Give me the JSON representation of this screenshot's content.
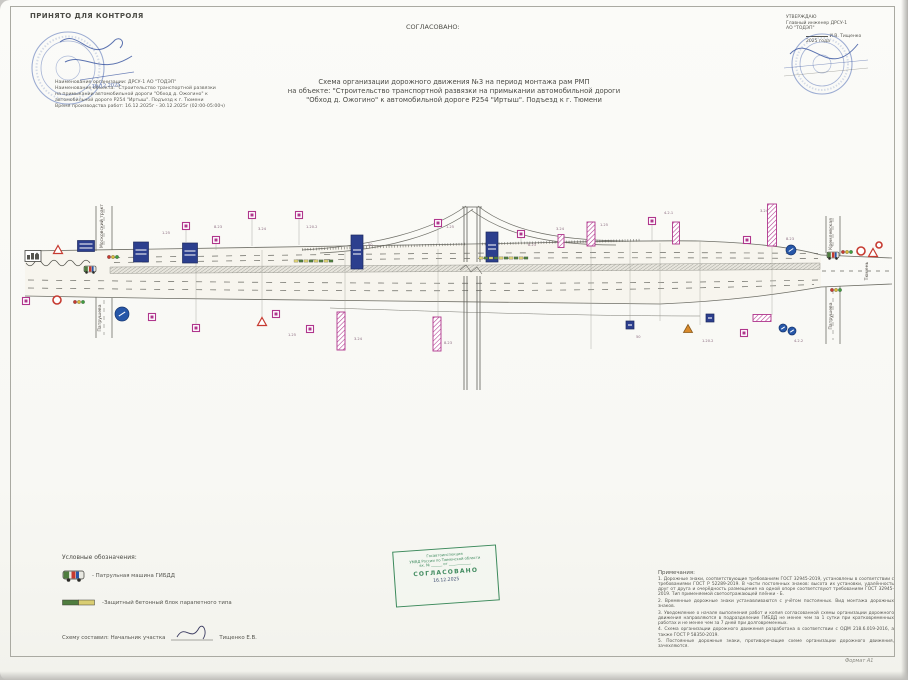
{
  "page": {
    "format_label": "Формат А1"
  },
  "colors": {
    "magenta": "#b0368c",
    "board_blue": "#2c3f8e",
    "sign_blue": "#2757a8",
    "sign_red": "#c63a30",
    "stamp_blue": "#4f6cb4",
    "stamp_green": "#3d8a5c",
    "block_green": "#4f7d3f",
    "block_yellow": "#d9cd72"
  },
  "header": {
    "accepted_title": "ПРИНЯТО ДЛЯ КОНТРОЛЯ",
    "handwritten_date": "16.12.2025",
    "agreed_label": "СОГЛАСОВАНО:",
    "approved": {
      "line1": "УТВЕРЖДАЮ",
      "line2": "Главный инженер ДРСУ-1",
      "line3": "АО \"ТОДЭП\"",
      "name": "И.В. Тищенко",
      "year": "2025 года"
    },
    "info_lines": [
      "Наименование организации: ДРСУ-1 АО \"ТОДЭП\"",
      "Наименование объекта:  \"Строительство транспортной развязки",
      "на примыкании   автомобильной дороги  \"Обход д. Ожогино\" к",
      "автомобильной дороге Р254 \"Иртыш\". Подъезд к г. Тюмени",
      "Время производства работ: 16.12.2025г - 30.12.2025г (02:00-05:00ч)"
    ]
  },
  "title": {
    "line1": "Схема организации дорожного движения №3 на период монтажа рам РМП",
    "line2": "на объекте: \"Строительство транспортной развязки на примыкании    автомобильной дороги",
    "line3": "\"Обход д. Ожогино\" к автомобильной дороге  Р254 \"Иртыш\". Подъезд к г. Тюмени"
  },
  "legend": {
    "title": "Условные обозначения:",
    "items": [
      {
        "icon": "patrol-car",
        "label": "- Патрульная машина ГИБДД"
      },
      {
        "icon": "protective-block",
        "label": "-Защитный бетонный блок парапетного типа"
      }
    ],
    "composer_prefix": "Схему составил: Начальник участка",
    "composer_name": "Тищенко Е.В."
  },
  "green_stamp": {
    "line1": "Госавтоинспекция",
    "line2": "УМВД России по Тюменской области",
    "line3": "вх. № ______ от ____________",
    "title": "СОГЛАСОВАНО",
    "date": "16.12.2025"
  },
  "notes": {
    "title": "Примечания:",
    "items": [
      "1. Дорожные знаки, соответствующие требованиям ГОСТ 32945-2019, установлены в соответствии с требованиями ГОСТ Р 52289-2019. В части постоянных знаков: высота их установки, удалённость друг от друга и очерёдность размещения на одной опоре соответствуют требованиям ГОСТ 32945-2019. Тип применяемой светоотражающей плёнки - Б.",
      "2. Временные дорожные знаки устанавливаются с учётом постоянных. Вид монтажа дорожных знаков.",
      "3. Уведомление о начале выполнения работ и копия согласованной схемы организации дорожного движения направляются в подразделение ГИБДД не менее чем за 1 сутки при кратковременных работах и не менее чем за 7 дней при долговременных.",
      "4. Схема организации дорожного движения разработана в соответствии с ОДМ 218.6.019-2016, а также ГОСТ Р 58350-2019.",
      "5. Постоянные дорожные знаки, противоречащие схеме организации дорожного движения, зачехляются."
    ]
  },
  "diagram": {
    "street_labels": [
      {
        "text": "Московский тракт",
        "x": 103,
        "y": 226
      },
      {
        "text": "Патрушева",
        "x": 101,
        "y": 318
      },
      {
        "text": "Кремлевская",
        "x": 832,
        "y": 234
      },
      {
        "text": "Патрушева",
        "x": 832,
        "y": 316
      },
      {
        "text": "Тюмень",
        "x": 868,
        "y": 271
      }
    ],
    "sign_codes": [
      {
        "t": "1.25",
        "x": 162,
        "y": 234
      },
      {
        "t": "8.23",
        "x": 214,
        "y": 228
      },
      {
        "t": "3.24",
        "x": 258,
        "y": 230
      },
      {
        "t": "1.20.2",
        "x": 306,
        "y": 228
      },
      {
        "t": "50",
        "x": 368,
        "y": 246
      },
      {
        "t": "1.25",
        "x": 446,
        "y": 228
      },
      {
        "t": "8.23",
        "x": 528,
        "y": 246
      },
      {
        "t": "3.24",
        "x": 556,
        "y": 230
      },
      {
        "t": "1.25",
        "x": 600,
        "y": 226
      },
      {
        "t": "4.2.1",
        "x": 664,
        "y": 214
      },
      {
        "t": "3.24",
        "x": 760,
        "y": 212
      },
      {
        "t": "8.23",
        "x": 786,
        "y": 240
      },
      {
        "t": "1.25",
        "x": 288,
        "y": 336
      },
      {
        "t": "3.24",
        "x": 354,
        "y": 340
      },
      {
        "t": "8.23",
        "x": 444,
        "y": 344
      },
      {
        "t": "1.20.2",
        "x": 702,
        "y": 342
      },
      {
        "t": "50",
        "x": 636,
        "y": 338
      },
      {
        "t": "4.2.2",
        "x": 794,
        "y": 342
      }
    ],
    "block_rows": [
      {
        "x1": 294,
        "x2": 332,
        "y": 261
      },
      {
        "x1": 479,
        "x2": 526,
        "y": 258
      }
    ],
    "signs": [
      {
        "type": "city",
        "x": 33,
        "y": 256
      },
      {
        "type": "triangle",
        "x": 58,
        "y": 250
      },
      {
        "type": "blue-board",
        "x": 86,
        "y": 246,
        "w": 17,
        "h": 11
      },
      {
        "type": "blue-board",
        "x": 141,
        "y": 252,
        "w": 15,
        "h": 20
      },
      {
        "type": "blue-board",
        "x": 190,
        "y": 253,
        "w": 15,
        "h": 20
      },
      {
        "type": "m-sq",
        "x": 186,
        "y": 226,
        "ld": 242
      },
      {
        "type": "m-sq",
        "x": 216,
        "y": 240,
        "ld": 250
      },
      {
        "type": "m-sq",
        "x": 252,
        "y": 215,
        "ld": 246
      },
      {
        "type": "m-sq",
        "x": 299,
        "y": 215,
        "ld": 245
      },
      {
        "type": "blue-board",
        "x": 357,
        "y": 252,
        "w": 12,
        "h": 34
      },
      {
        "type": "m-sq",
        "x": 438,
        "y": 223,
        "ld": 245
      },
      {
        "type": "blue-board",
        "x": 492,
        "y": 247,
        "w": 12,
        "h": 30
      },
      {
        "type": "m-sq",
        "x": 521,
        "y": 234,
        "ld": 243
      },
      {
        "type": "m-board",
        "x": 561,
        "y": 241,
        "w": 6,
        "h": 13
      },
      {
        "type": "m-board",
        "x": 591,
        "y": 234,
        "w": 8,
        "h": 24
      },
      {
        "type": "m-sq",
        "x": 652,
        "y": 221,
        "ld": 241
      },
      {
        "type": "m-board",
        "x": 676,
        "y": 233,
        "w": 7,
        "h": 22
      },
      {
        "type": "m-sq",
        "x": 747,
        "y": 240
      },
      {
        "type": "m-board",
        "x": 772,
        "y": 225,
        "w": 9,
        "h": 42
      },
      {
        "type": "blue-circle",
        "x": 791,
        "y": 250,
        "r": 5
      },
      {
        "type": "car",
        "x": 833,
        "y": 255
      },
      {
        "type": "tl",
        "x": 847,
        "y": 252
      },
      {
        "type": "red-circle",
        "x": 861,
        "y": 251,
        "r": 4
      },
      {
        "type": "triangle",
        "x": 873,
        "y": 253
      },
      {
        "type": "red-circle",
        "x": 879,
        "y": 245,
        "r": 3
      },
      {
        "type": "m-sq",
        "x": 26,
        "y": 301
      },
      {
        "type": "red-circle",
        "x": 57,
        "y": 300,
        "r": 4
      },
      {
        "type": "tl",
        "x": 79,
        "y": 302
      },
      {
        "type": "blue-circle",
        "x": 122,
        "y": 314,
        "r": 7
      },
      {
        "type": "m-sq",
        "x": 152,
        "y": 317
      },
      {
        "type": "m-sq",
        "x": 196,
        "y": 328
      },
      {
        "type": "triangle",
        "x": 262,
        "y": 322
      },
      {
        "type": "m-sq",
        "x": 276,
        "y": 314
      },
      {
        "type": "m-sq",
        "x": 310,
        "y": 329
      },
      {
        "type": "m-board",
        "x": 341,
        "y": 331,
        "w": 8,
        "h": 38
      },
      {
        "type": "m-board",
        "x": 437,
        "y": 334,
        "w": 8,
        "h": 34
      },
      {
        "type": "blue-sq",
        "x": 630,
        "y": 325
      },
      {
        "type": "orange-triangle",
        "x": 688,
        "y": 329
      },
      {
        "type": "blue-sq",
        "x": 710,
        "y": 318
      },
      {
        "type": "m-rect",
        "x": 762,
        "y": 318,
        "w": 18,
        "h": 7
      },
      {
        "type": "blue-circle",
        "x": 783,
        "y": 328,
        "r": 4
      },
      {
        "type": "blue-circle",
        "x": 792,
        "y": 331,
        "r": 4
      },
      {
        "type": "m-sq",
        "x": 744,
        "y": 333
      },
      {
        "type": "tl",
        "x": 836,
        "y": 290
      },
      {
        "type": "car",
        "x": 90,
        "y": 269
      },
      {
        "type": "tl",
        "x": 113,
        "y": 257
      }
    ]
  }
}
